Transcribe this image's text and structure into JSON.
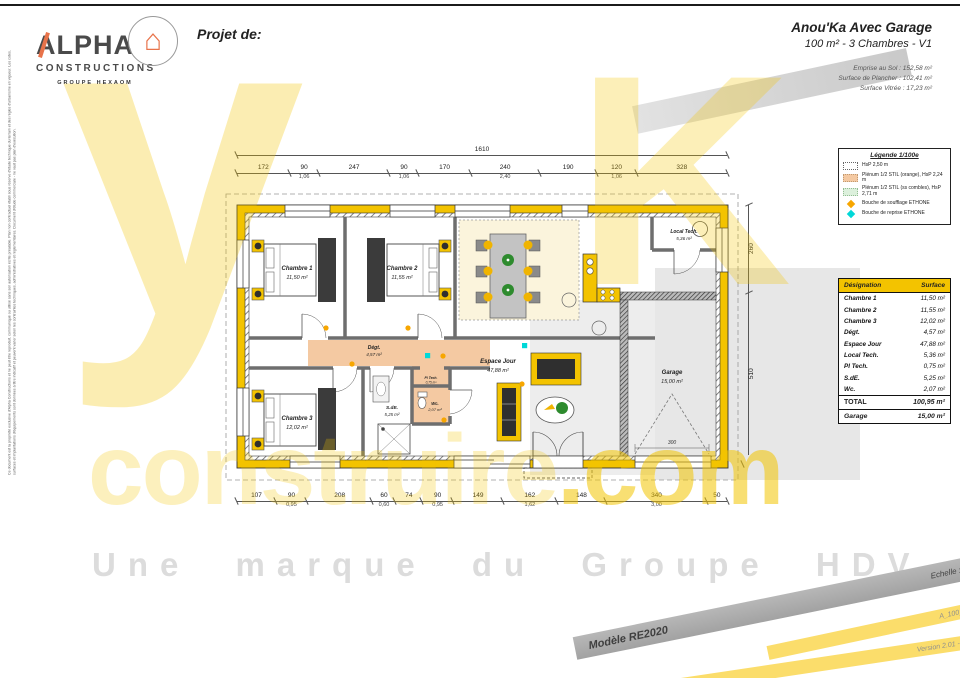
{
  "logo": {
    "name_top": "ALPHA",
    "name_bottom": "CONSTRUCTIONS",
    "group": "GROUPE HEXAOM"
  },
  "icons": {
    "house": "⌂"
  },
  "header": {
    "project_label": "Projet de:",
    "title": "Anou'Ka Avec Garage",
    "subtitle": "100 m² - 3 Chambres - V1",
    "metrics": [
      "Emprise au Sol : 152,58 m²",
      "Surface de Plancher : 102,41 m²",
      "Surface Vitrée : 17,23 m²"
    ]
  },
  "legend": {
    "title": "Légende 1/100e",
    "items": [
      {
        "type": "dotted",
        "label": "HsP 2,50 m"
      },
      {
        "type": "orange",
        "label": "Plénum 1/2 STIL (orange), HsP 2,24 m"
      },
      {
        "type": "green",
        "label": "Plénum 1/2 STIL (ss combles), HsP 2,71 m"
      },
      {
        "type": "dot-orange",
        "label": "Bouche de soufflage ETHONE"
      },
      {
        "type": "dot-cyan",
        "label": "Bouche de reprise ETHONE"
      }
    ]
  },
  "table": {
    "headers": [
      "Désignation",
      "Surface"
    ],
    "rows": [
      [
        "Chambre 1",
        "11,50 m²"
      ],
      [
        "Chambre 2",
        "11,55 m²"
      ],
      [
        "Chambre 3",
        "12,02 m²"
      ],
      [
        "Dégt.",
        "4,57 m²"
      ],
      [
        "Espace Jour",
        "47,88 m²"
      ],
      [
        "Local Tech.",
        "5,36 m²"
      ],
      [
        "Pl Tech.",
        "0,75 m²"
      ],
      [
        "S.dE.",
        "5,25 m²"
      ],
      [
        "Wc.",
        "2,07 m²"
      ]
    ],
    "total": [
      "TOTAL",
      "100,95 m²"
    ],
    "garage": [
      "Garage",
      "15,00 m²"
    ]
  },
  "plan": {
    "rooms": [
      {
        "name": "Chambre 1",
        "area": "11,50 m²"
      },
      {
        "name": "Chambre 2",
        "area": "11,55 m²"
      },
      {
        "name": "Chambre 3",
        "area": "12,02 m²"
      },
      {
        "name": "Dégt.",
        "area": "4,57 m²"
      },
      {
        "name": "Espace Jour",
        "area": "47,88 m²"
      },
      {
        "name": "Local Tech.",
        "area": "5,36 m²"
      },
      {
        "name": "Pl Tech.",
        "area": "0,75 m²"
      },
      {
        "name": "S.dE.",
        "area": "5,25 m²"
      },
      {
        "name": "Wc.",
        "area": "2,07 m²"
      },
      {
        "name": "Garage",
        "area": "15,00 m²"
      }
    ],
    "dims": {
      "total_top": "1610",
      "garage_door": "300",
      "top": [
        {
          "v": "172"
        },
        {
          "v": "90",
          "s": "1,06"
        },
        {
          "v": "247"
        },
        {
          "v": "90",
          "s": "1,06"
        },
        {
          "v": "170"
        },
        {
          "v": "240",
          "s": "2,40"
        },
        {
          "v": "190"
        },
        {
          "v": "120",
          "s": "1,06"
        },
        {
          "v": "328"
        }
      ],
      "bottom": [
        {
          "v": "107"
        },
        {
          "v": "90",
          "s": "0,95"
        },
        {
          "v": "208"
        },
        {
          "v": "60",
          "s": "0,60"
        },
        {
          "v": "74"
        },
        {
          "v": "90",
          "s": "0,95"
        },
        {
          "v": "149"
        },
        {
          "v": "162",
          "s": "1,62"
        },
        {
          "v": "148"
        },
        {
          "v": "340",
          "s": "3,00"
        },
        {
          "v": "50"
        }
      ],
      "right": [
        {
          "v": "260"
        },
        {
          "v": "510"
        }
      ]
    }
  },
  "watermark": {
    "big_y": "y",
    "big_k": "K",
    "word": "construire",
    "tld": ".com",
    "tagline": "Une marque du Groupe HDV"
  },
  "banners": {
    "model": "Modèle RE2020",
    "scale": "Echelle : 1/75e",
    "code": "A_100_3C_G_V1",
    "version": "Version 2.01 - Mars 2023"
  },
  "disclaimer": {
    "text": "Ce document est la propriété exclusive d'Alpha Constructions et ne peut être reproduit, communiqué ou utilisé sans son autorisation écrite préalable. Plan non contractuel établi sous réserve d'étude technique du terrain et des règles d'urbanisme en vigueur. Les cotes, surfaces et implantations d'équipements sont données à titre indicatif et peuvent varier selon les contraintes techniques, administratives et réglementaires. Document d'étude commerciale - ne vaut pas plan d'exécution."
  },
  "colors": {
    "wall_yellow": "#F3C300",
    "plenum_orange": "#F4C9A2",
    "plenum_green": "#DCF0DC",
    "supply_vent": "#F7A600",
    "return_vent": "#00D8D8",
    "logo_orange": "#E8734A"
  }
}
